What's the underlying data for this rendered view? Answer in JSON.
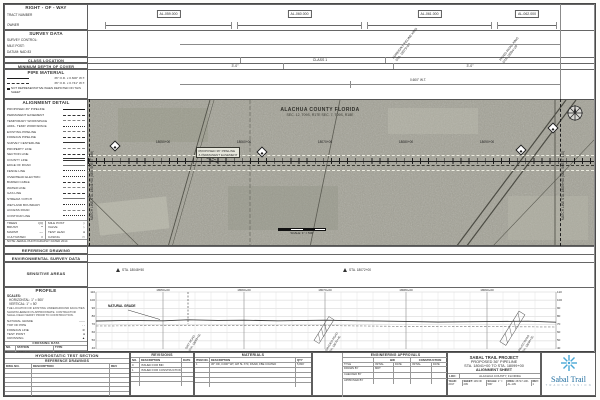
{
  "sidebar": {
    "row": {
      "title": "RIGHT - OF - WAY",
      "rows": [
        "TRACT NUMBER",
        "OWNER"
      ]
    },
    "survey": {
      "title": "SURVEY DATA",
      "rows": [
        "SURVEY CONTROL:",
        "MILE POST:",
        "DATUM: NAD 83"
      ]
    },
    "class_location": {
      "title": "CLASS LOCATION",
      "value": "CLASS 1"
    },
    "depth": {
      "title": "MINIMUM DEPTH OF COVER",
      "values": [
        "3'-0\"",
        "3'-0\""
      ]
    },
    "pipe_material": {
      "title": "PIPE MATERIAL",
      "items": [
        "36\" O.D. x 0.600\" W.T.",
        "36\" O.D. x 0.741\" W.T."
      ],
      "note": "NOT REPRESENTATIVE WHEN DEPICTED ON THIS SHEET",
      "band_label": "0.600\" W.T."
    },
    "alignment_detail": {
      "title": "ALIGNMENT DETAIL",
      "items": [
        "PROPOSED 36\" PIPELINE",
        "PERMANENT EASEMENT",
        "TEMPORARY WORKSPACE",
        "ADDL. TEMP. WORKSPACE",
        "EXISTING PIPELINE",
        "FOREIGN PIPELINE",
        "SURVEY CENTERLINE",
        "PROPERTY LINE",
        "SECTION LINE",
        "COUNTY LINE",
        "EDGE OF ROAD",
        "FENCE LINE",
        "OVERHEAD ELECTRIC",
        "BURIED CABLE",
        "WATER LINE",
        "GAS LINE",
        "STREAM / DITCH",
        "WETLAND BOUNDARY",
        "ACCESS ROAD",
        "CONTOUR LINE"
      ],
      "mini": [
        {
          "label": "TREES",
          "sym": "QQ"
        },
        {
          "label": "BRUSH",
          "sym": "**"
        },
        {
          "label": "MARSH",
          "sym": "~~"
        },
        {
          "label": "CULTIVATED",
          "sym": "//"
        },
        {
          "label": "MILE POST",
          "sym": "◇"
        },
        {
          "label": "VALVE",
          "sym": "▷"
        },
        {
          "label": "TEST LEAD",
          "sym": "●"
        },
        {
          "label": "CASING",
          "sym": "▭"
        }
      ],
      "note": "NOTE: AERIAL PHOTOGRAPHY DATED 2014"
    },
    "reference_drawing": "REFERENCE DRAWING",
    "environmental": "ENVIRONMENTAL SURVEY DATA",
    "sensitive": "SENSITIVE AREAS",
    "profile_box": {
      "title": "PROFILE",
      "scales": [
        "SCALES:",
        "HORIZONTAL: 1\" = 500'",
        "VERTICAL: 1\" = 50'"
      ],
      "note": "THE LOCATION OF EXISTING UNDERGROUND FACILITIES SHOWN HEREON IS APPROXIMATE. CONTRACTOR SHALL FIELD VERIFY PRIOR TO CONSTRUCTION.",
      "legend": [
        {
          "label": "NATURAL GRADE",
          "sym": "——"
        },
        {
          "label": "TOP OF PIPE",
          "sym": "- -"
        },
        {
          "label": "FOREIGN LINE",
          "sym": "⊘"
        },
        {
          "label": "TEST POINT",
          "sym": "●"
        },
        {
          "label": "CROSSING",
          "sym": "▲"
        }
      ],
      "table": {
        "title": "CROSSING DATA",
        "cols": [
          "NO.",
          "STATION",
          "TYPE"
        ],
        "rows": [
          [
            "1",
            "18053+00",
            "ROAD"
          ],
          [
            "2",
            "18070+40",
            "ROAD"
          ],
          [
            "3",
            "18094+20",
            "ROAD"
          ]
        ]
      }
    },
    "hydro": {
      "title": "HYDROSTATIC TEST SECTION",
      "sub": "REFERENCE DRAWINGS",
      "cols": [
        "DWG NO.",
        "DESCRIPTION",
        "REV"
      ]
    }
  },
  "top_band": {
    "tracts": [
      "AL-059.000",
      "AL-060.000",
      "AL-061.000",
      "AL-062.000"
    ],
    "crossing_calls": [
      {
        "l1": "FOREIGN PIPELINE XING",
        "l2": "STA. 18079+60"
      },
      {
        "l1": "PAVED ROAD XING",
        "l2": "STA. 18094+20"
      }
    ]
  },
  "map": {
    "county": "ALACHUA COUNTY FLORIDA",
    "sections": "SEC. 12, T09S, R17E      SEC. 7, T09S, R18E",
    "pipeline_label_1": "PROPOSED 36\" PIPELINE",
    "pipeline_label_2": "& PERMANENT EASEMENT",
    "match_left": "MATCH LINE STA. 18041+00 (SEE SHEET 138)",
    "match_right": "MATCH LINE STA. 18099+00 (SEE SHEET 140)",
    "stations": [
      "18050+00",
      "18060+00",
      "18070+00",
      "18080+00",
      "18090+00"
    ],
    "scale_label": "SCALE: 1\" = 500'"
  },
  "sensitive_band": {
    "markers": [
      "STA. 18048+50",
      "STA. 18072+00"
    ]
  },
  "profile": {
    "elevations": [
      "110",
      "100",
      "90",
      "80",
      "70",
      "60",
      "50",
      "40"
    ],
    "stations": [
      "18050+00",
      "18060+00",
      "18070+00",
      "18080+00",
      "18090+00"
    ],
    "grade_label": "NATURAL GRADE",
    "crossings": [
      {
        "l1": "DIRT ROAD",
        "l2": "STA. 18053+00"
      },
      {
        "l1": "GRADED ROAD",
        "l2": "STA. 18070+40"
      },
      {
        "l1": "PAVED ROAD",
        "l2": "STA. 18094+20"
      }
    ]
  },
  "bottom": {
    "revisions": {
      "title": "REVISIONS",
      "cols": [
        "NO.",
        "DESCRIPTION",
        "DATE"
      ],
      "rows": [
        [
          "0",
          "ISSUED FOR BID",
          ""
        ],
        [
          "1",
          "ISSUED FOR CONSTRUCTION",
          ""
        ]
      ]
    },
    "materials": {
      "title": "MATERIALS",
      "cols": [
        "ITEM NO.",
        "DESCRIPTION",
        "QTY"
      ],
      "rows": [
        [
          "1",
          "36\" OD, 0.600\" WT, API 5L X70, DSAW, FBE COATED",
          "5,800'"
        ]
      ]
    },
    "approvals": {
      "title": "ENGINEERING APPROVALS",
      "groups": [
        "BID",
        "CONSTRUCTION"
      ],
      "sub": [
        "TITLE",
        "INITIAL",
        "DATE",
        "INITIAL",
        "DATE"
      ],
      "rows": [
        [
          "DRAWN BY",
          "MDT"
        ],
        [
          "CHECKED BY",
          ""
        ],
        [
          "APPROVED BY",
          ""
        ]
      ]
    },
    "title_block": {
      "l1": "SABAL TRAIL PROJECT",
      "l2": "PROPOSED 36\" PIPELINE",
      "l3": "STA. 18041+00 TO STA. 18099+00",
      "l4": "ALIGNMENT SHEET",
      "loc_label": "LOC:",
      "loc": "ALACHUA COUNTY, FLORIDA",
      "year_label": "YEAR:",
      "year": "2017",
      "sheet_label": "SHEET:",
      "sheet": "139 OF 209",
      "scale_label": "SCALE:",
      "scale": "1\" = 500'",
      "dwg_label": "DWG:",
      "dwg": "26717-100-AL-139",
      "rev_label": "REV:",
      "rev": "1"
    },
    "logo": {
      "name": "Sabal Trail",
      "sub": "T R A N S M I S S I O N"
    }
  }
}
